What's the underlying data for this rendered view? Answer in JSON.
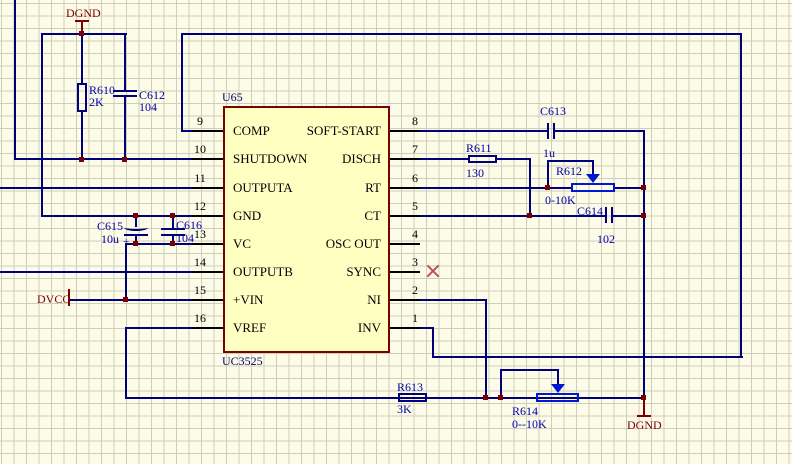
{
  "app": {
    "kind": "schematic sheet (EDA capture view)"
  },
  "colors": {
    "background": "#fdfce9",
    "grid": "#cfceba",
    "wire": "#00007d",
    "junction": "#7d0000",
    "ic_fill": "#ffffc2",
    "ic_border": "#7d0000",
    "label_blue": "#0000a8",
    "power_maroon": "#7d0000",
    "wiper_blue": "#0018cf",
    "no_connect_red": "#c0504d"
  },
  "ic": {
    "designator": "U65",
    "part": "UC3525",
    "left_pins": [
      {
        "num": "9",
        "name": "COMP"
      },
      {
        "num": "10",
        "name": "SHUTDOWN"
      },
      {
        "num": "11",
        "name": "OUTPUTA"
      },
      {
        "num": "12",
        "name": "GND"
      },
      {
        "num": "13",
        "name": "VC"
      },
      {
        "num": "14",
        "name": "OUTPUTB"
      },
      {
        "num": "15",
        "name": "+VIN"
      },
      {
        "num": "16",
        "name": "VREF"
      }
    ],
    "right_pins": [
      {
        "num": "8",
        "name": "SOFT-START"
      },
      {
        "num": "7",
        "name": "DISCH"
      },
      {
        "num": "6",
        "name": "RT"
      },
      {
        "num": "5",
        "name": "CT"
      },
      {
        "num": "4",
        "name": "OSC OUT"
      },
      {
        "num": "3",
        "name": "SYNC"
      },
      {
        "num": "2",
        "name": "NI"
      },
      {
        "num": "1",
        "name": "INV"
      }
    ]
  },
  "components": {
    "r610": {
      "ref": "R610",
      "value": "2K"
    },
    "c612": {
      "ref": "C612",
      "value": "104"
    },
    "c615": {
      "ref": "C615",
      "value": "10u",
      "polarity": "+"
    },
    "c616": {
      "ref": "C616",
      "value": "104"
    },
    "c613": {
      "ref": "C613",
      "value": "1u"
    },
    "r611": {
      "ref": "R611",
      "value": "130"
    },
    "r612": {
      "ref": "R612",
      "value": "0-10K"
    },
    "c614": {
      "ref": "C614",
      "value": "102"
    },
    "r613": {
      "ref": "R613",
      "value": "3K"
    },
    "r614": {
      "ref": "R614",
      "value": "0--10K"
    }
  },
  "power_ports": {
    "dgnd_top": "DGND",
    "dvcc": "DVCC",
    "dgnd_bottom": "DGND"
  }
}
